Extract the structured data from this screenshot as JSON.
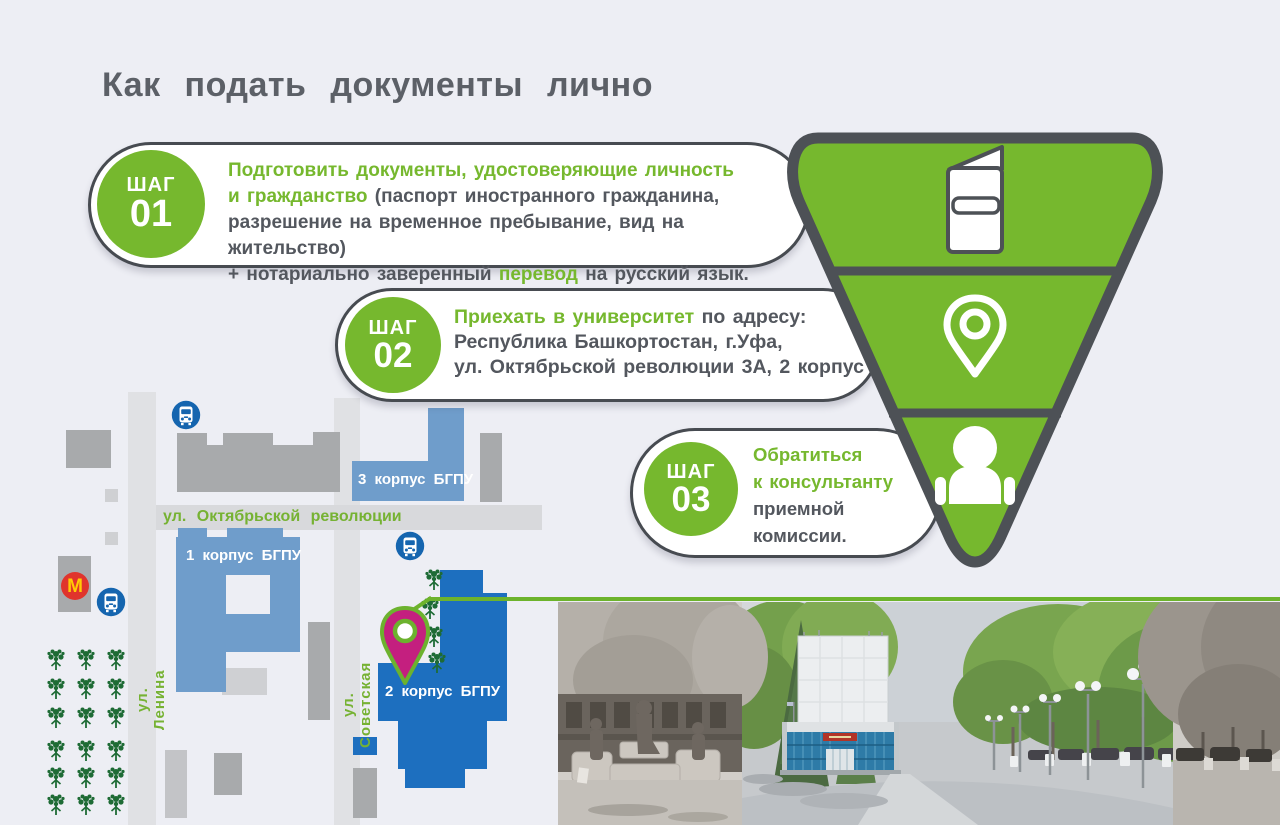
{
  "title": "Как подать документы лично",
  "steps": [
    {
      "step_label": "ШАГ",
      "step_number": "01",
      "lines": [
        [
          {
            "t": "Подготовить документы, удостоверяющие личность",
            "g": true
          }
        ],
        [
          {
            "t": "и гражданство",
            "g": true
          },
          {
            "t": " (паспорт иностранного гражданина,",
            "g": false
          }
        ],
        [
          {
            "t": "разрешение на временное пребывание, вид на жительство)",
            "g": false
          }
        ],
        [
          {
            "t": "+ нотариально заверенный ",
            "g": false
          },
          {
            "t": "перевод",
            "g": true
          },
          {
            "t": " на русский язык.",
            "g": false
          }
        ]
      ]
    },
    {
      "step_label": "ШАГ",
      "step_number": "02",
      "lines": [
        [
          {
            "t": "Приехать в университет",
            "g": true
          },
          {
            "t": " по адресу:",
            "g": false
          }
        ],
        [
          {
            "t": "Республика Башкортостан, г.Уфа,",
            "g": false
          }
        ],
        [
          {
            "t": "ул. Октябрьской революции 3А, 2 корпус",
            "g": false
          }
        ]
      ]
    },
    {
      "step_label": "ШАГ",
      "step_number": "03",
      "lines": [
        [
          {
            "t": "Обратиться",
            "g": true
          }
        ],
        [
          {
            "t": "к консультанту",
            "g": true
          }
        ],
        [
          {
            "t": "приемной",
            "g": false
          }
        ],
        [
          {
            "t": "комиссии.",
            "g": false
          }
        ]
      ]
    }
  ],
  "funnel": {
    "sections": [
      {
        "icon": "passport-icon"
      },
      {
        "icon": "location-pin-icon"
      },
      {
        "icon": "consultant-person-icon"
      }
    ]
  },
  "map": {
    "street_oktyabrskoy": "ул. Октябрьской революции",
    "street_lenina": "ул. Ленина",
    "street_sovetskaya": "ул. Советская",
    "building_korpus1": "1 корпус БГПУ",
    "building_korpus2": "2 корпус БГПУ",
    "building_korpus3": "3 корпус БГПУ",
    "mcdonalds_letter": "M"
  },
  "colors": {
    "background": "#edeef4",
    "accent_green": "#76b82e",
    "route_green": "#6db32c",
    "dark_gray": "#4d5156",
    "text_dark": "#53575e",
    "pin_magenta": "#c41f7f",
    "building_blue_bright": "#1d6fbf",
    "building_blue_light": "#6f9dcb",
    "bus_icon_blue": "#1565af",
    "mcdonalds_red": "#e0342c",
    "mcdonalds_yellow": "#ffcb05",
    "tree_green": "#1e6b35"
  }
}
